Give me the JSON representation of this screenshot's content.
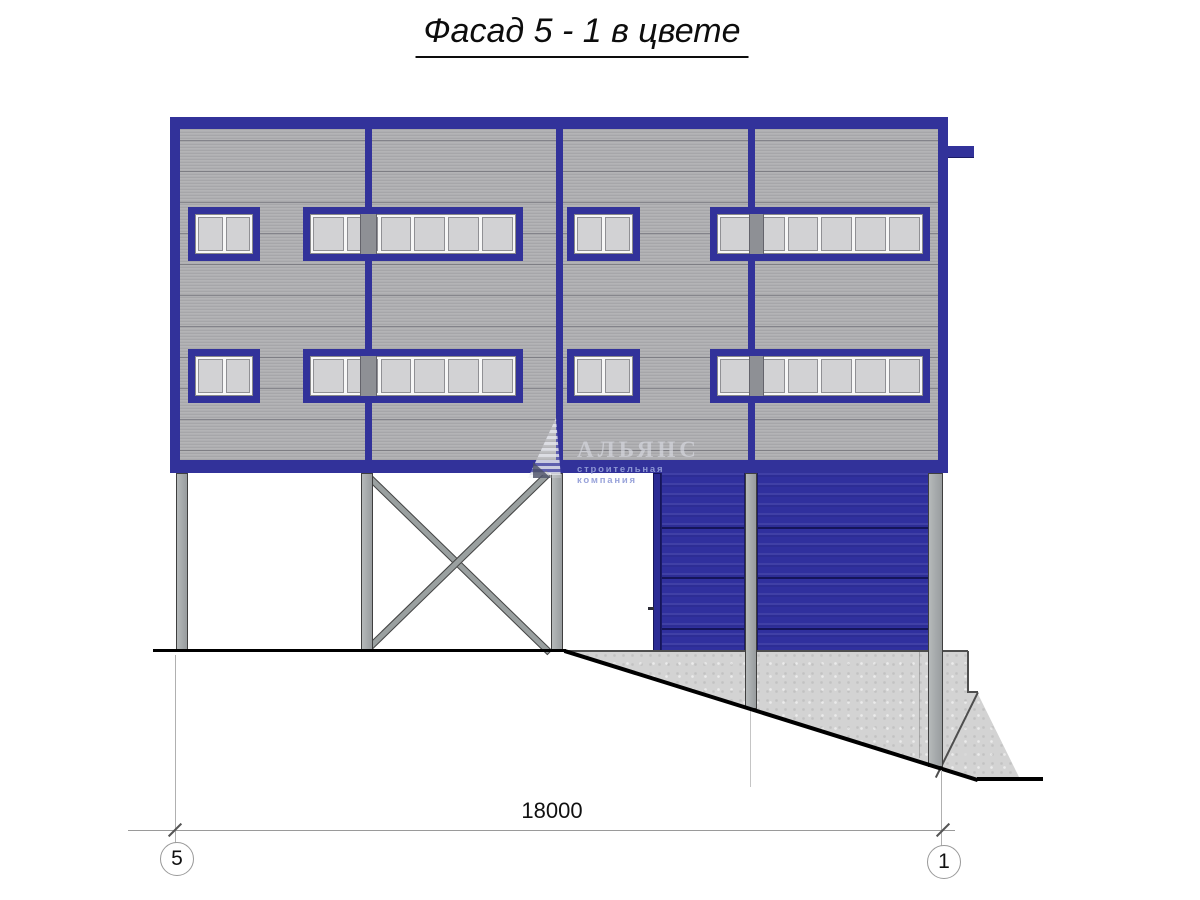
{
  "title": "Фасад 5 - 1 в цвете",
  "watermark": {
    "logo_icon": "sail-icon",
    "company_name": "АЛЬЯНС",
    "tagline": "строительная компания"
  },
  "dimension": {
    "span_label": "18000",
    "axis_left_label": "5",
    "axis_right_label": "1"
  },
  "colors": {
    "frame_blue": "#32329a",
    "door_blue": "#30309e",
    "siding_gray": "#afafb2",
    "glass_gray": "#d2d2d4",
    "column_gray": "#a2a6a7",
    "concrete_gray": "#d3d3d3",
    "ground_black": "#000000"
  }
}
